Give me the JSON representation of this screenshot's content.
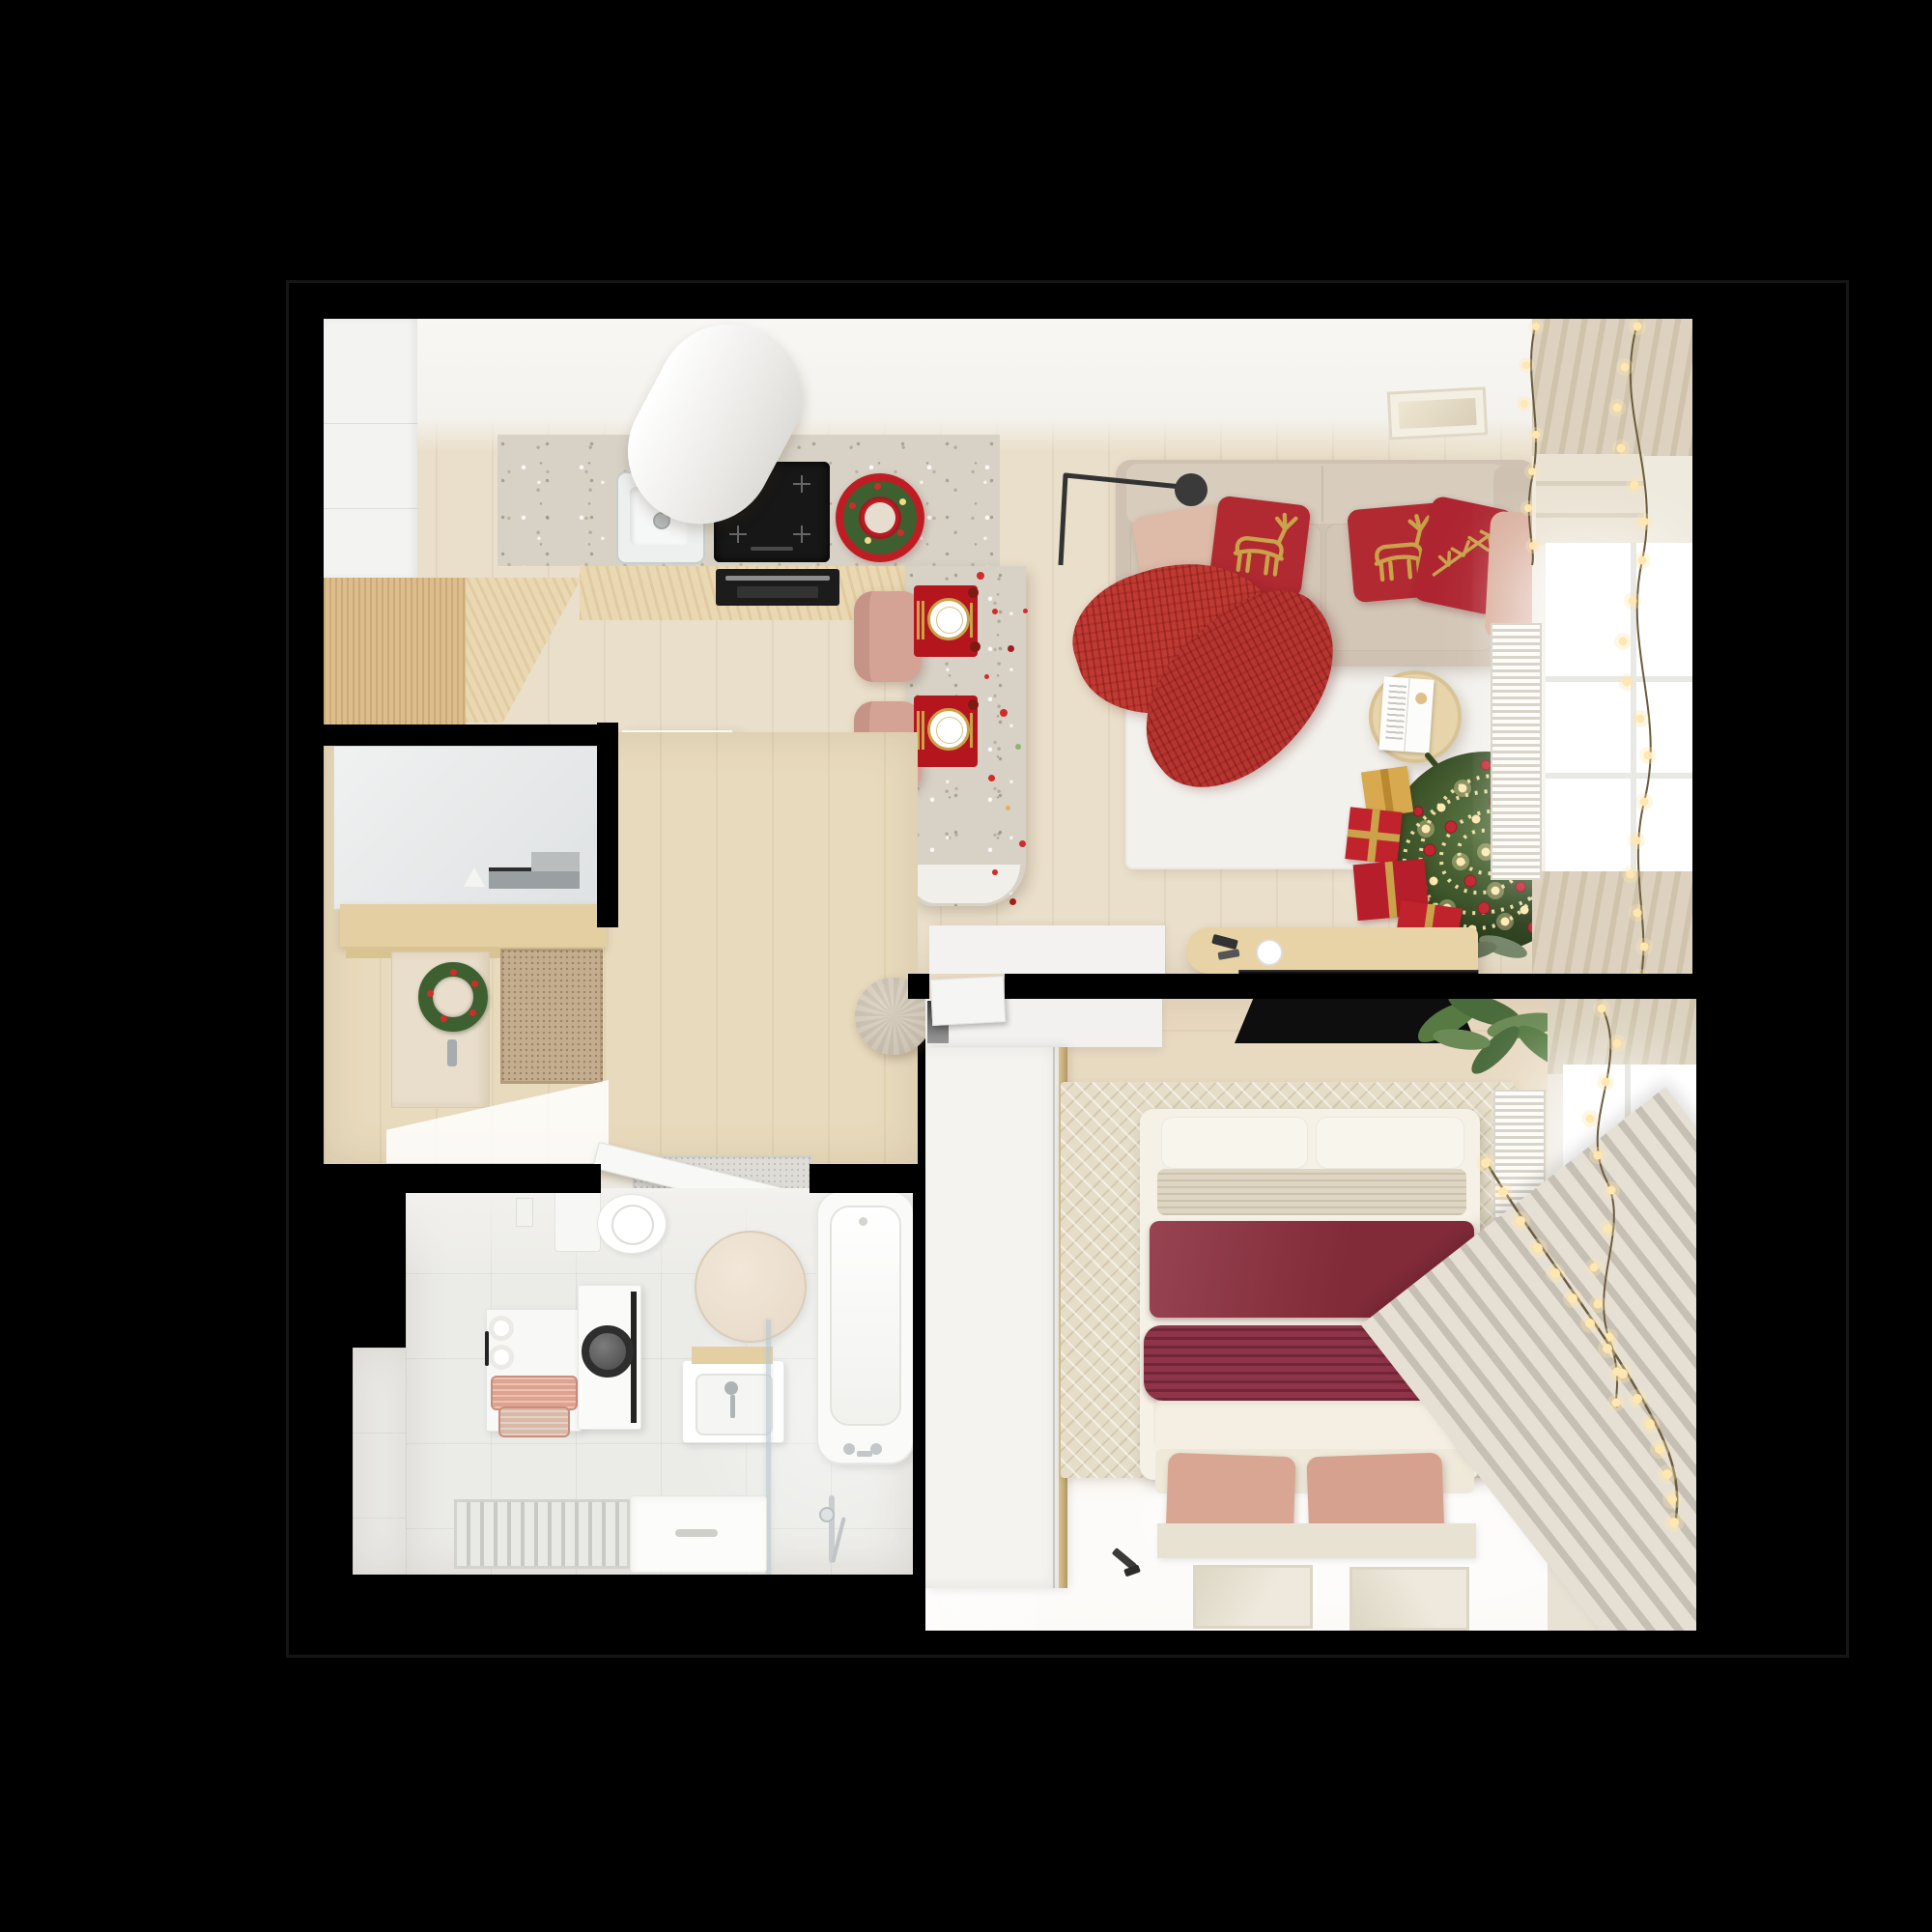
{
  "scene": {
    "type": "3d-floor-plan-top-view",
    "description": "Photoreal top-down render of a small studio apartment decorated for Christmas: open kitchen/living room, hallway, bathroom and bedroom on a black background",
    "style": "warm beige and white interior with red christmas accents and glowing string lights"
  },
  "palette": {
    "bg": "#000000",
    "outline": "#161616",
    "floor-wood": "#eadfca",
    "floor-hall": "#e8dabc",
    "floor-bed": "#e8d9c1",
    "wall-white": "#f6f5f2",
    "cabinet-white": "#f3f3f1",
    "terrazzo": "#d8d2c6",
    "oak": "#ddbd8c",
    "oak-light": "#ead8b2",
    "wood-shelf": "#e3cfa2",
    "appliance-black": "#171717",
    "steel": "#a7acae",
    "wreath-green": "#3e6030",
    "wreath-red": "#c01c24",
    "berry-red": "#d22b2b",
    "placemat-red": "#b5161d",
    "gold": "#c9a24a",
    "chair-blush": "#d5a396",
    "sofa-beige": "#cfc2b2",
    "sofa-light": "#d8ccbd",
    "seat-beige": "#d3c6b6",
    "pillow-red": "#b12a32",
    "pillow-blush": "#debba9",
    "throw-red": "#bf3a33",
    "rug-white": "#f3f1ec",
    "rug-beige": "#e5ddc8",
    "table-wood": "#e7d4ab",
    "gift-gold": "#d8a94e",
    "gift-red": "#c0232c",
    "tv-black": "#0e0e0e",
    "console-wood": "#e8d3a6",
    "curtain": "#dcd2bf",
    "curtain-dark": "#cfc3ab",
    "curtain-diag-a": "#e6e0d4",
    "curtain-diag-b": "#c6c0b4",
    "window-white": "#ffffff",
    "radiator": "#f4f2ed",
    "radiator-line": "#d9d4ca",
    "light-warm": "#ffe7ae",
    "light-wire": "#6b5c3d",
    "bath-floor": "#ebebe8",
    "fixture": "#fafaf9",
    "washer-door": "#2e2e2e",
    "basket-pink": "#dfa28f",
    "glass": "#bac8ce",
    "bed-duvet": "#f5f1e6",
    "knit-beige": "#ded6c2",
    "wine": "#8c2e3d",
    "wine2": "#8f3449",
    "bench": "#efe9da",
    "pillow-rose": "#d9a693",
    "wardrobe": "#f4f3f0",
    "brass": "#c9b07c",
    "door-beige": "#e9decb",
    "mat-coir": "#c4ad8e",
    "mat-gray": "#dedcd6",
    "pouf": "#cfc5b6",
    "mirror-beige": "#e9dccb",
    "plant": "#567a42",
    "frame-art": "#eee9dc",
    "sconce": "#3a3a3a"
  },
  "rooms": {
    "kitchen": {
      "label": "kitchen",
      "objects": [
        "tall-white-cabinets",
        "oak-base-cabinets",
        "terrazzo-countertop",
        "undermount-sink",
        "faucet",
        "induction-cooktop",
        "built-in-oven",
        "cylindrical-extractor-hood",
        "christmas-wreath-on-counter",
        "breakfast-peninsula",
        "red-placemats",
        "dinner-plates",
        "gold-cutlery",
        "blush-bar-chairs",
        "red-confetti"
      ]
    },
    "living_room": {
      "label": "living room",
      "objects": [
        "beige-sofa",
        "red-reindeer-pillows",
        "blush-pillows",
        "red-knit-throw",
        "black-arc-floor-lamp",
        "white-area-rug",
        "round-wood-coffee-table",
        "open-magazine",
        "decorated-christmas-tree",
        "gift-boxes",
        "string-light-garlands",
        "tv-console",
        "flat-tv",
        "white-sideboard",
        "radiator",
        "window-with-curtains",
        "roman-shade",
        "ceiling-vent"
      ]
    },
    "hallway": {
      "label": "hallway",
      "objects": [
        "built-in-closet",
        "floating-console-shelf",
        "keys-and-electronics",
        "entry-door",
        "christmas-wreath-on-door",
        "coir-doormat",
        "gray-doormat",
        "open-white-door",
        "knitted-pouf"
      ]
    },
    "bathroom": {
      "label": "bathroom",
      "objects": [
        "toilet",
        "wall-socket",
        "round-mirror",
        "wall-shelf-unit",
        "toilet-paper-rolls",
        "pink-storage-baskets",
        "washing-machine",
        "washbasin-cabinet",
        "glass-shower-screen",
        "shower-tray",
        "floor-drain",
        "towel-radiator",
        "bathtub",
        "bath-faucet",
        "hand-shower"
      ]
    },
    "bedroom": {
      "label": "bedroom",
      "objects": [
        "sliding-door-wardrobe",
        "brass-trim",
        "white-dresser",
        "wall-mounted-tv",
        "double-bed",
        "white-pillows",
        "burgundy-blanket",
        "burgundy-knit-runner",
        "herringbone-rug",
        "bench-with-blush-cushions",
        "wall-art-frames",
        "black-sconces",
        "round-bedside-table",
        "candle",
        "potted-plant",
        "radiator",
        "window-with-curtains",
        "string-light-garland"
      ]
    }
  }
}
